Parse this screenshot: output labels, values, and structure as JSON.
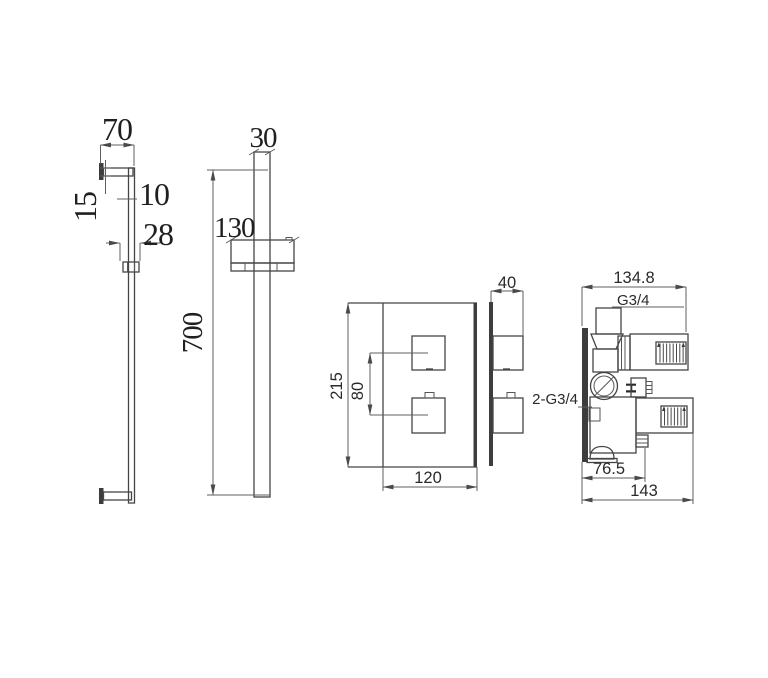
{
  "title": "shower-column-and-thermostatic-valve-technical-drawing",
  "colors": {
    "background": "#ffffff",
    "object_line": "#454545",
    "dimension_line": "#5f5f5f",
    "text": "#1f1f1f",
    "solid_fill": "#3d3d3d"
  },
  "rail_side": {
    "arm_length": "70",
    "arm_thickness": "15",
    "rail_depth": "10",
    "bracket_depth": "28"
  },
  "rail_front": {
    "rail_width": "30",
    "slider_width": "130",
    "rail_length": "700"
  },
  "valve_front": {
    "plate_height": "215",
    "knob_spacing": "80",
    "plate_width": "120"
  },
  "valve_side": {
    "plate_depth": "40"
  },
  "valve_body": {
    "overall_depth": "134.8",
    "top_outlet_thread": "G3/4",
    "inlet_threads": "2-G3/4",
    "hot_marker": "H",
    "body_depth": "76.5",
    "total_depth": "143"
  }
}
